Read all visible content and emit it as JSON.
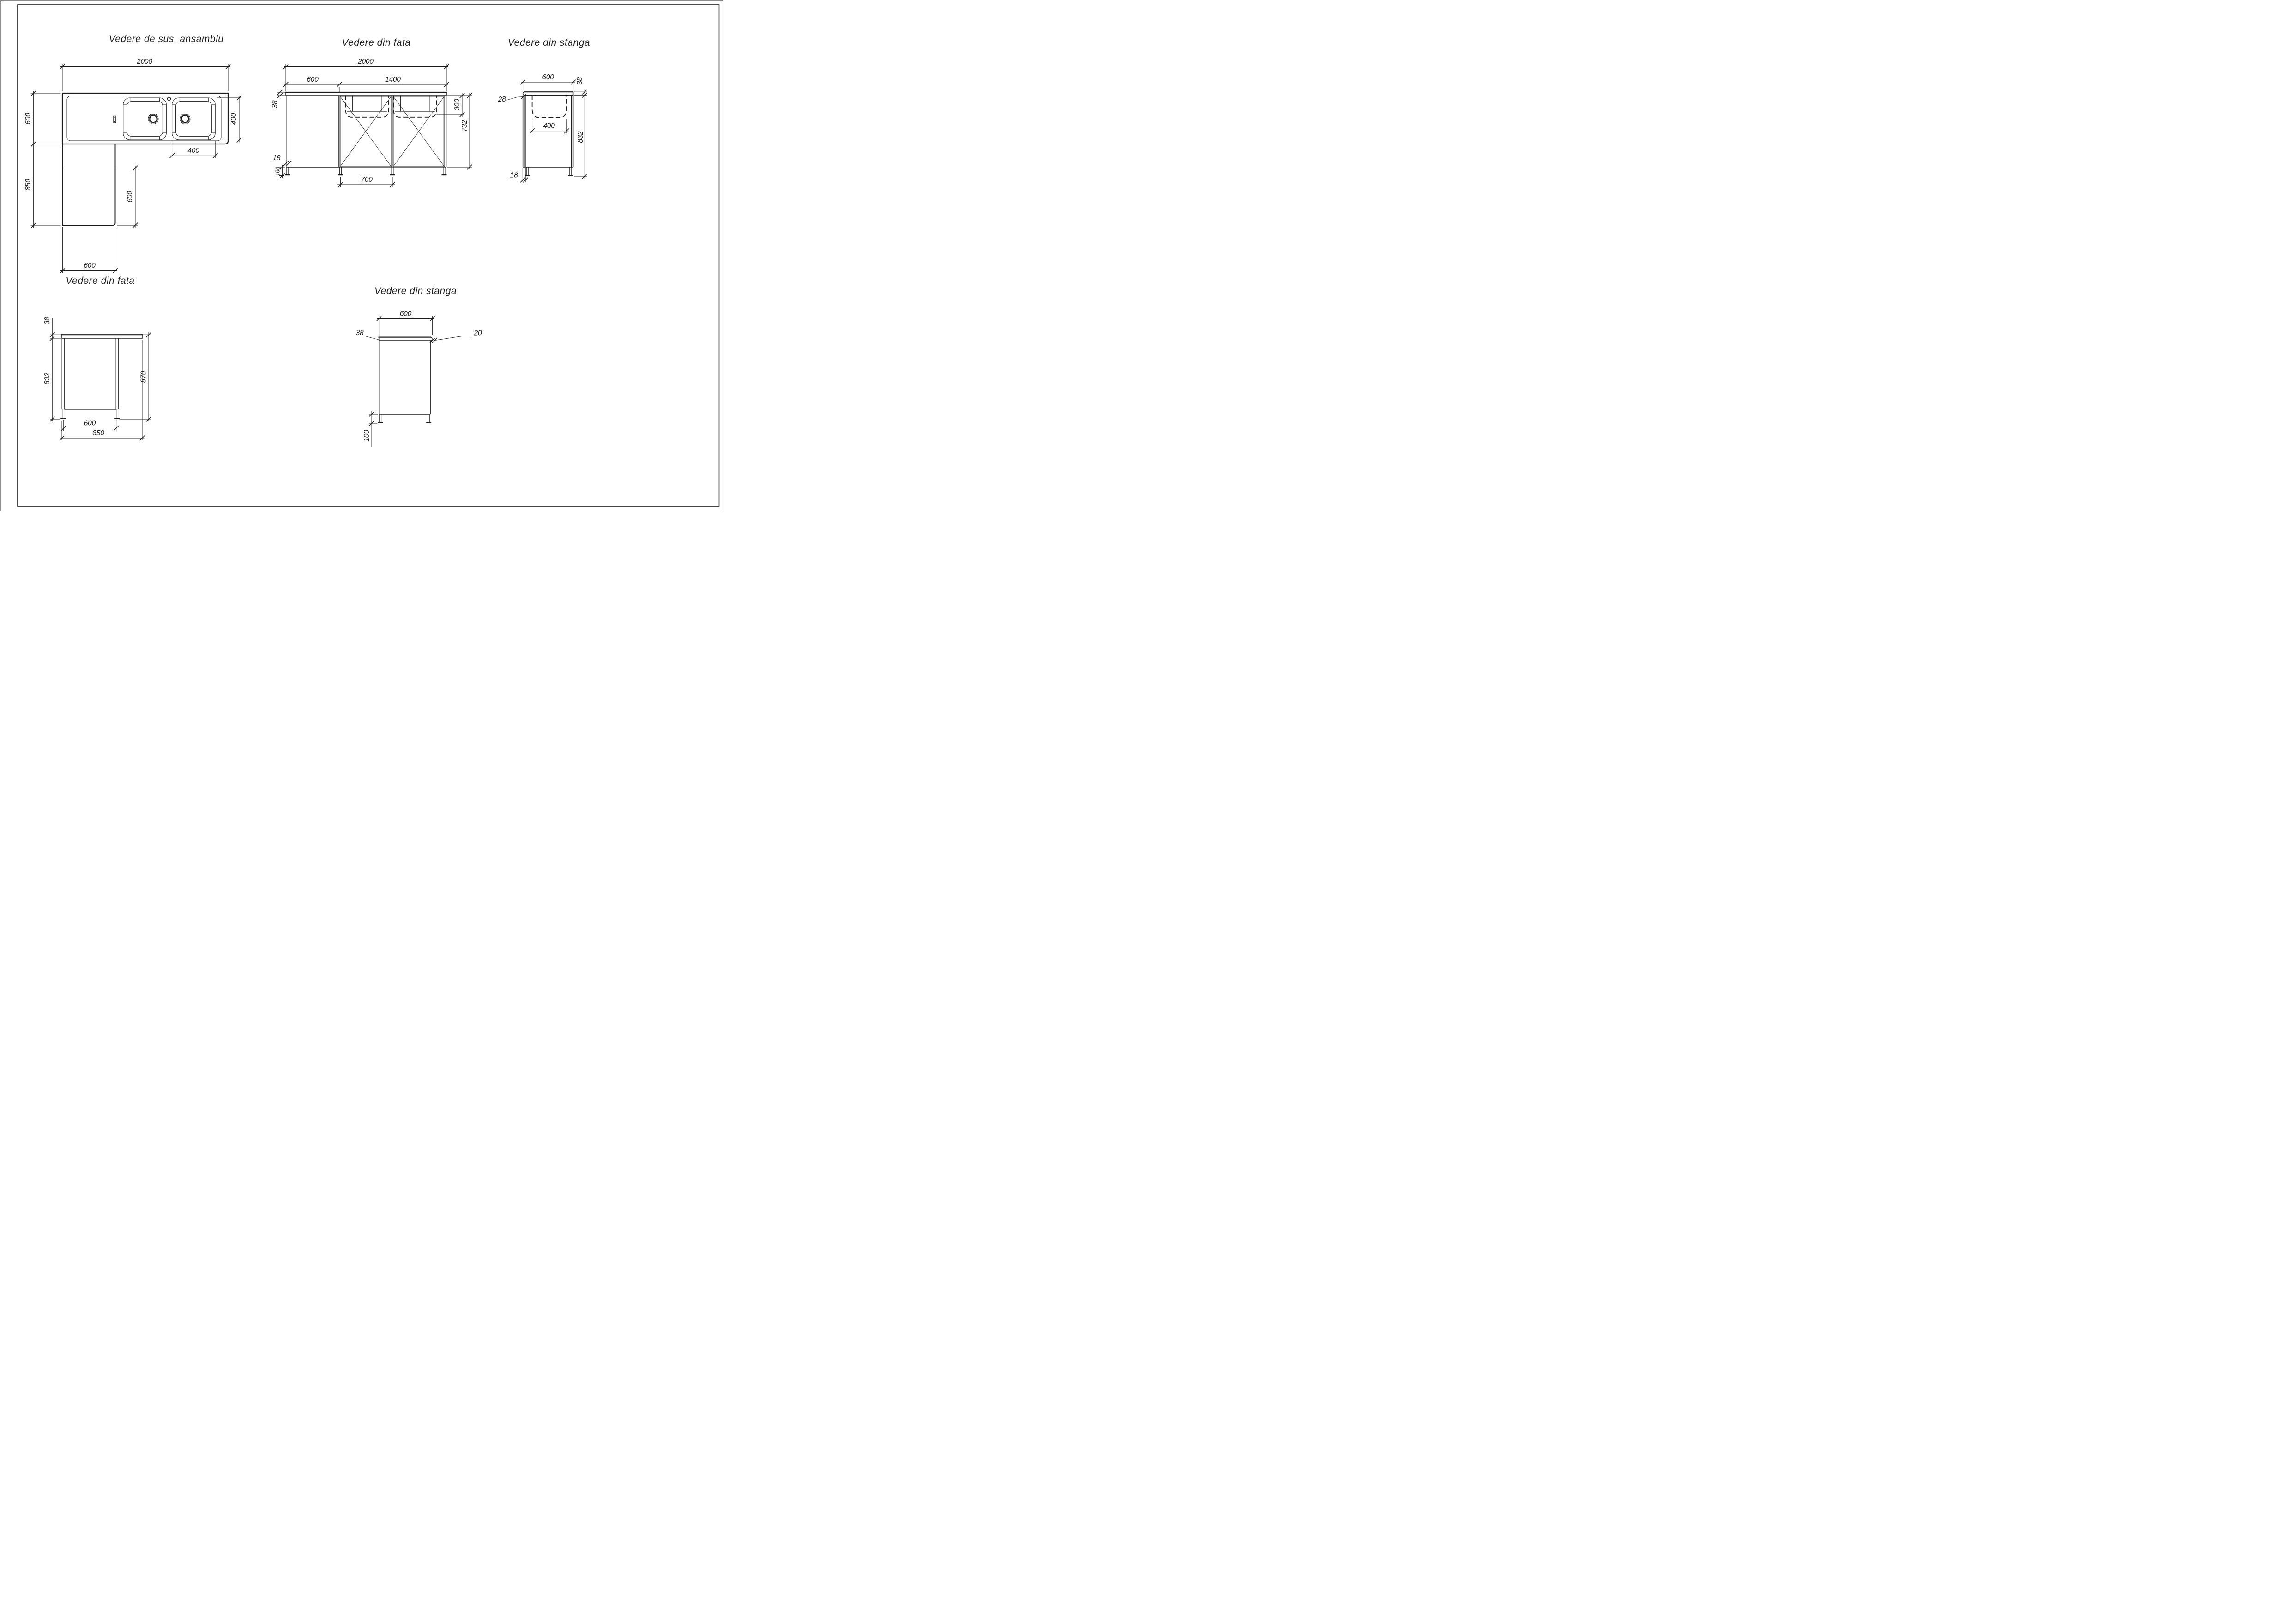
{
  "sheet": {
    "background": "#ffffff",
    "line_color": "#1c1c1c",
    "door_accent_color": "#8a8a8a"
  },
  "views": {
    "top_assembly": {
      "title": "Vedere de sus, ansamblu",
      "dims": {
        "overall_width": "2000",
        "counter_depth": "600",
        "return_length": "850",
        "return_inner": "600",
        "return_width": "600",
        "sink_module_depth": "400",
        "bowl_width": "400"
      }
    },
    "front_assembly": {
      "title": "Vedere din fata",
      "dims": {
        "overall_width": "2000",
        "drainboard_width": "600",
        "cabinet_width": "1400",
        "countertop_thickness": "38",
        "bowl_depth": "300",
        "cabinet_height": "732",
        "panel_thickness": "18",
        "leg_height": "100",
        "door_width": "700"
      }
    },
    "left_assembly": {
      "title": "Vedere din stanga",
      "dims": {
        "counter_depth": "600",
        "countertop_thickness": "38",
        "front_panel_thickness": "28",
        "bowl_width": "400",
        "body_height": "832",
        "panel_thickness": "18"
      }
    },
    "front_return": {
      "title": "Vedere din fata",
      "dims": {
        "countertop_thickness": "38",
        "body_height": "832",
        "total_height": "870",
        "inner_width": "600",
        "overall_width": "850"
      }
    },
    "left_return": {
      "title": "Vedere din stanga",
      "dims": {
        "top_width": "600",
        "countertop_thickness": "38",
        "edge_thickness": "20",
        "leg_height": "100"
      }
    }
  }
}
